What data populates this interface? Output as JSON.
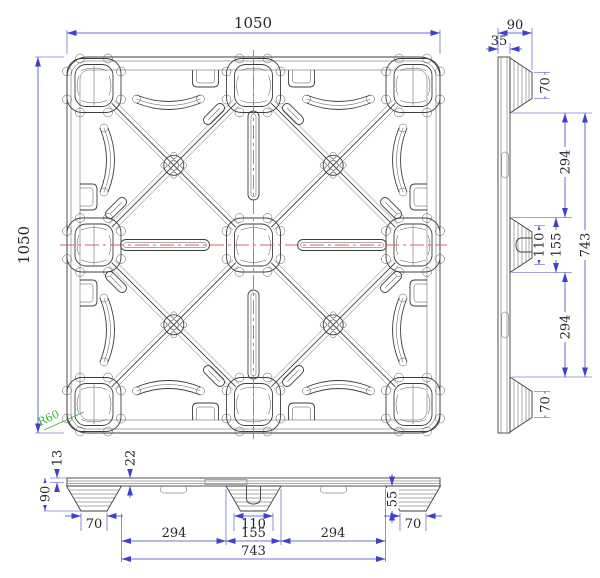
{
  "sheet": {
    "background": "#ffffff",
    "description": "plastic pallet engineering drawing, three orthographic views"
  },
  "colors": {
    "geometry_line": "#3d3d3d",
    "dimension_line": "#4040d0",
    "dimension_text": "#26262b",
    "centerline_red": "#e05d5d",
    "annotation_green": "#2eb82e"
  },
  "top_view": {
    "width_label": "1050",
    "height_label": "1050",
    "corner_radius_label": "R60"
  },
  "side_view": {
    "overall_width": "90",
    "deck_thickness": "35",
    "top_foot_tip": "70",
    "upper_gap": "294",
    "center_foot_tip": "110",
    "center_foot_base": "155",
    "feet_span": "743",
    "lower_gap": "294",
    "bottom_foot_tip": "70"
  },
  "front_view": {
    "top_lip": "13",
    "deck_thickness": "22",
    "overall_height": "90",
    "left_foot_tip": "70",
    "left_gap": "294",
    "center_foot_tip": "110",
    "center_foot_base": "155",
    "right_gap": "294",
    "right_foot_height": "55",
    "right_foot_tip": "70",
    "feet_span": "743"
  }
}
